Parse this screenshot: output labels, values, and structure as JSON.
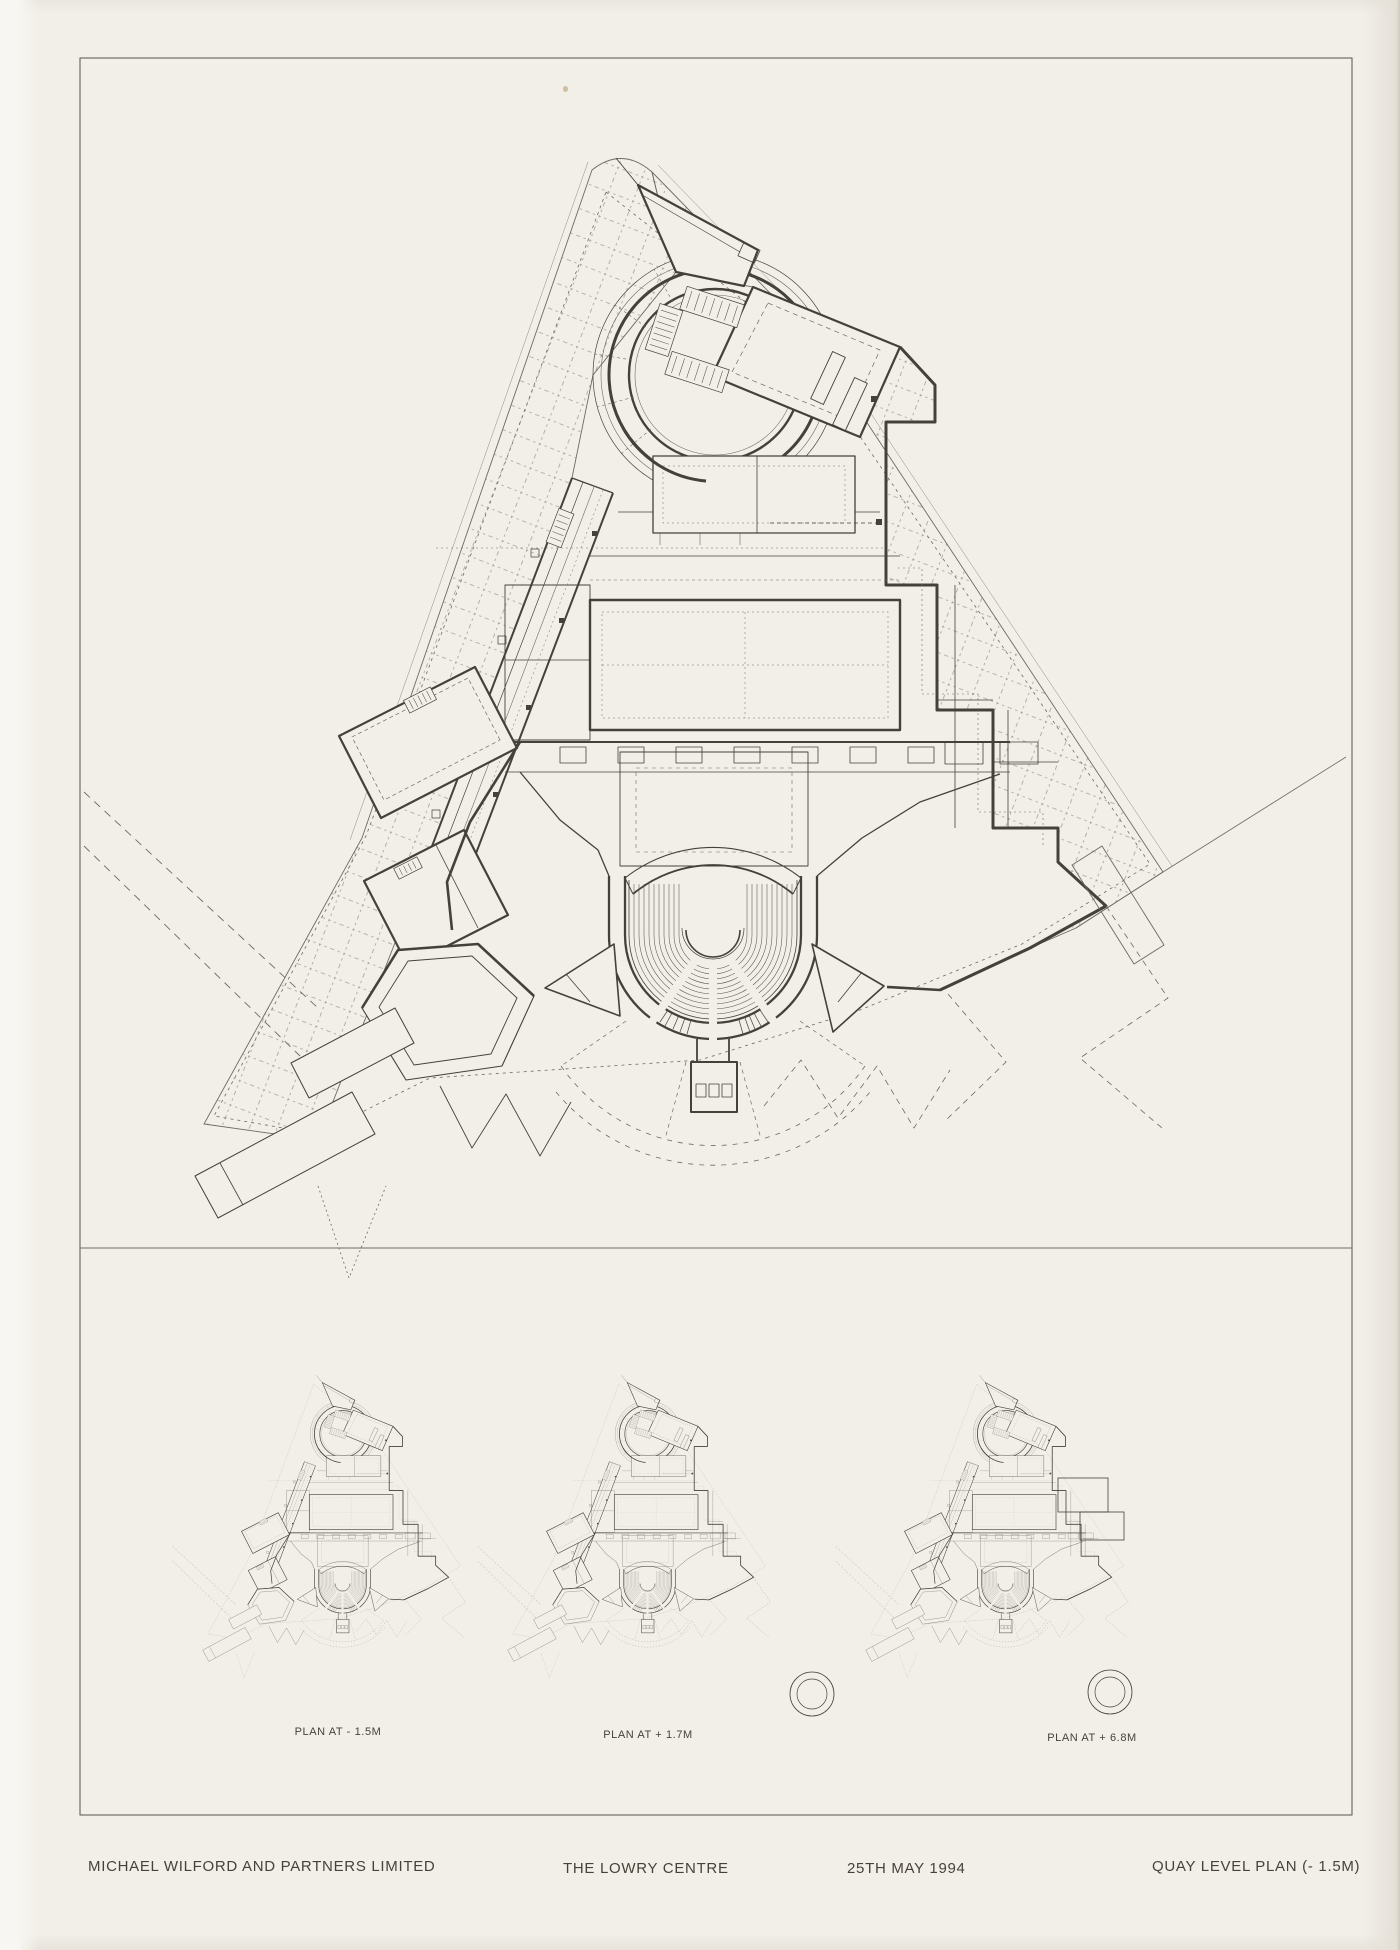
{
  "drawing": {
    "captions": {
      "plan1": "PLAN AT - 1.5M",
      "plan2": "PLAN AT + 1.7M",
      "plan3": "PLAN AT + 6.8M"
    },
    "title_block": {
      "architect": "MICHAEL WILFORD AND PARTNERS LIMITED",
      "project": "THE LOWRY CENTRE",
      "date": "25TH MAY 1994",
      "sheet_title": "QUAY LEVEL PLAN (- 1.5M)"
    },
    "colors": {
      "paper": "#f2efe9",
      "ink": "#45413a",
      "hatch": "#a8a095"
    }
  }
}
